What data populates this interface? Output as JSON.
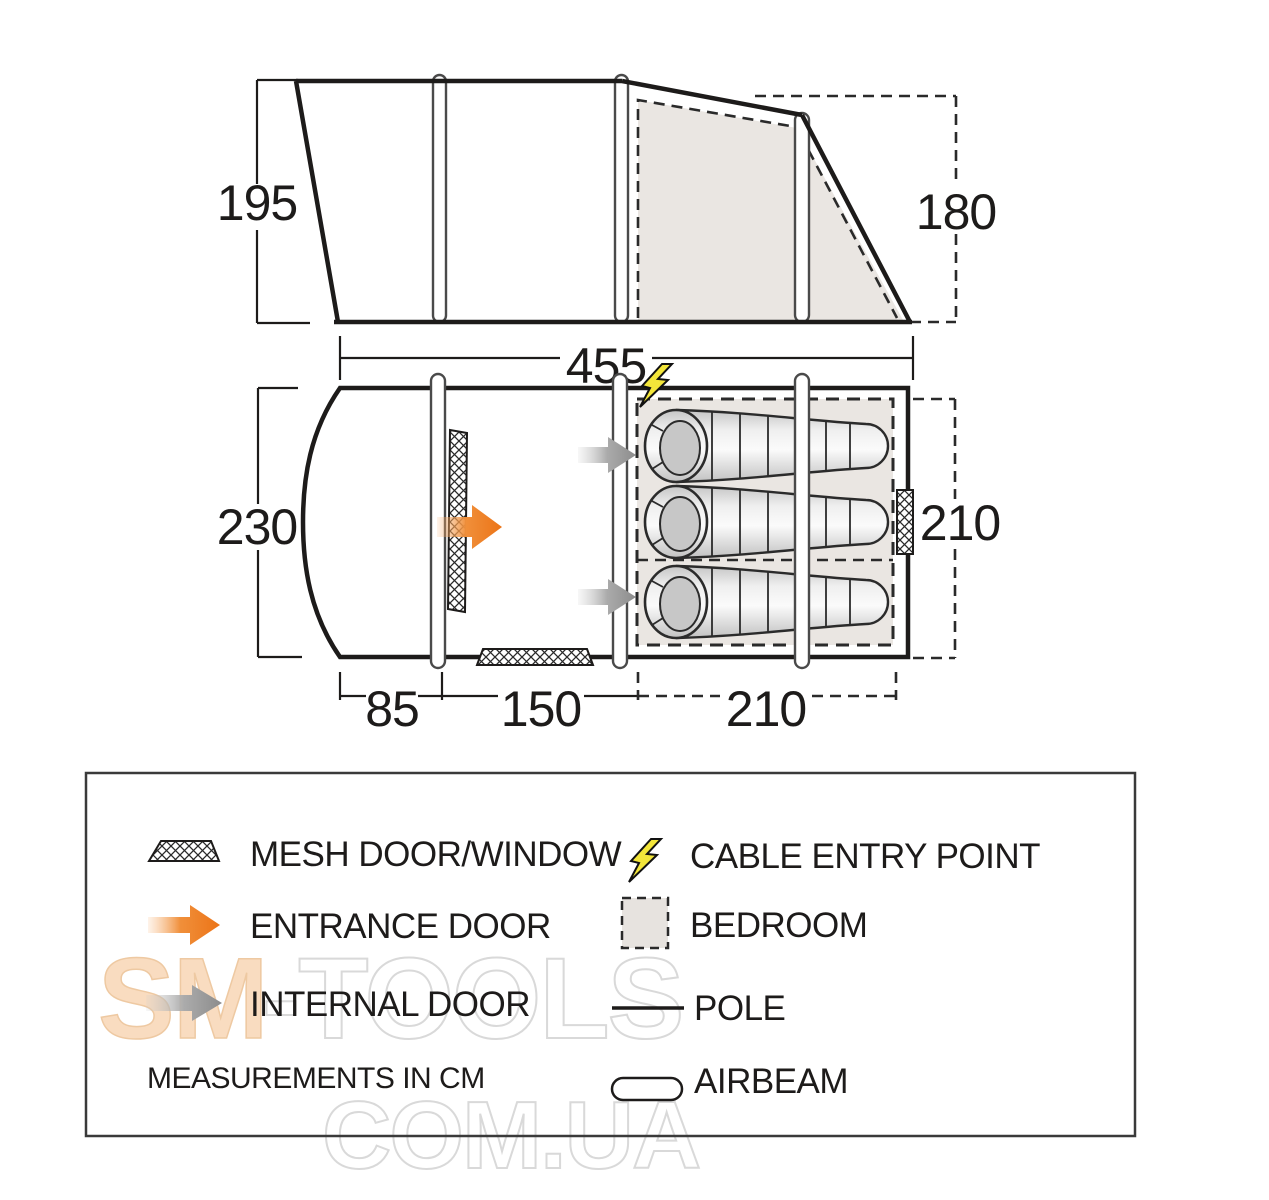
{
  "title": "Tent dimensions diagram",
  "side_view": {
    "front_height_cm": "195",
    "rear_height_cm": "180",
    "length_cm": "455"
  },
  "floor_plan": {
    "width_cm": "230",
    "bedroom_width_cm": "210",
    "front_section_cm": "85",
    "middle_section_cm": "150",
    "bedroom_section_cm": "210",
    "sleeping_bag_count": 3
  },
  "legend": {
    "mesh_label": "MESH DOOR/WINDOW",
    "cable_label": "CABLE ENTRY POINT",
    "entrance_label": "ENTRANCE DOOR",
    "bedroom_label": "BEDROOM",
    "internal_label": "INTERNAL DOOR",
    "pole_label": "POLE",
    "airbeam_label": "AIRBEAM",
    "note": "MEASUREMENTS IN CM"
  },
  "watermark": {
    "brand": "SM",
    "brand_suffix": "-TOOLS",
    "domain": "COM.UA"
  },
  "colors": {
    "line": "#1d1b1a",
    "bedroom_fill": "#eae6e2",
    "entrance_arrow": "#ec7417",
    "internal_arrow": "#8c8c8c",
    "cable_bolt": "#f3e63a",
    "watermark_peach": "#f9dcc0",
    "watermark_outline": "#d9d9d9"
  }
}
